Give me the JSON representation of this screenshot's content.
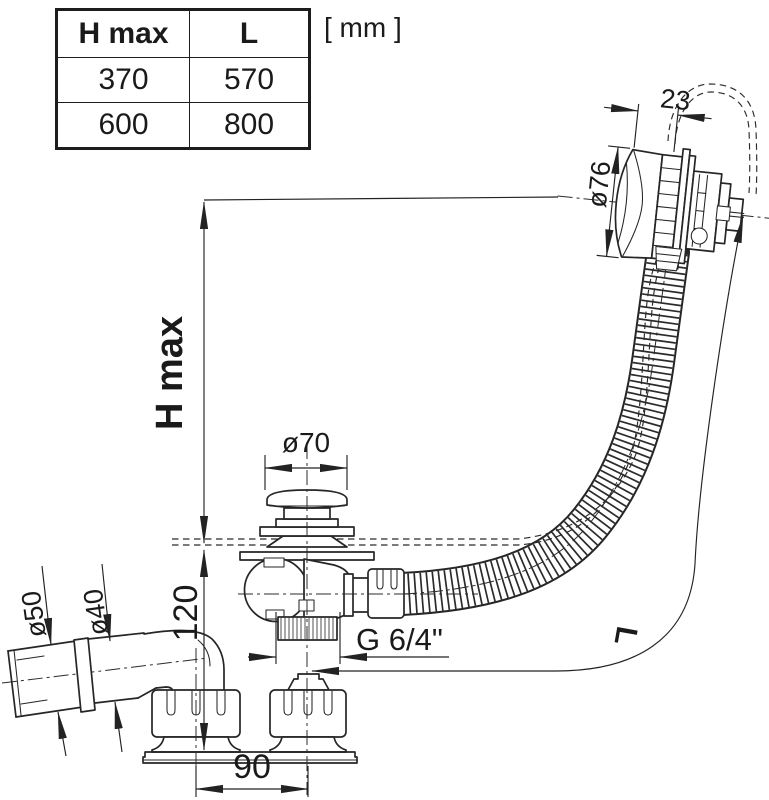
{
  "page": {
    "title": "bath-waste-overflow-technical-drawing",
    "background": "#ffffff",
    "line_color": "#262626"
  },
  "units_label": "[ mm ]",
  "table": {
    "headers": [
      "H max",
      "L"
    ],
    "rows": [
      [
        "370",
        "570"
      ],
      [
        "600",
        "800"
      ]
    ]
  },
  "labels": {
    "overflow_cap_width": "23",
    "overflow_cap_diameter": "ø76",
    "max_height": "H max",
    "plug_diameter": "ø70",
    "outlet_outer_diameter": "ø50",
    "outlet_inner_diameter": "ø40",
    "drain_depth": "120",
    "thread_size": "G 6/4\"",
    "hose_length": "L",
    "base_width": "90"
  }
}
